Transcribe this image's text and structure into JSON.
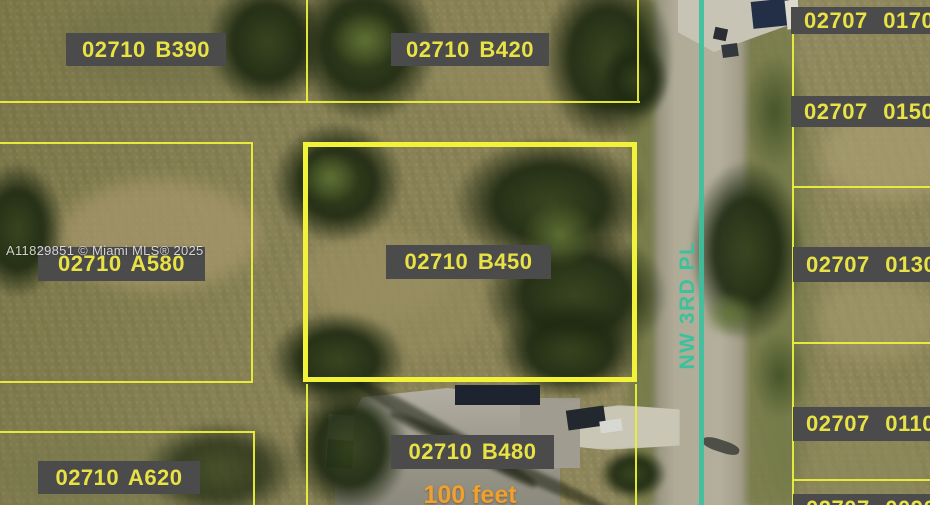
{
  "map": {
    "watermark": "A11829851 © Miami MLS® 2025",
    "street": {
      "name": "NW 3RD PL"
    },
    "scale": {
      "label": "100 feet"
    },
    "parcels": {
      "b390": {
        "label": "02710 B390"
      },
      "b420": {
        "label": "02710 B420"
      },
      "a580": {
        "label": "02710 A580"
      },
      "b450": {
        "label": "02710 B450",
        "highlighted": true
      },
      "a620": {
        "label": "02710 A620"
      },
      "b480": {
        "label": "02710 B480"
      },
      "r0170": {
        "label": "02707 0170"
      },
      "r0150": {
        "label": "02707 0150"
      },
      "r0130": {
        "label": "02707 0130"
      },
      "r0110": {
        "label": "02707 0110"
      },
      "r0090": {
        "label": "02707 0090"
      }
    },
    "colors": {
      "parcel_line": "#eaef3c",
      "highlight_line": "#f2f23a",
      "label_bg": "#4b4b4b",
      "label_text": "#e9e244",
      "street_marking": "#3cc09e",
      "scale_text": "#efa02e"
    }
  }
}
